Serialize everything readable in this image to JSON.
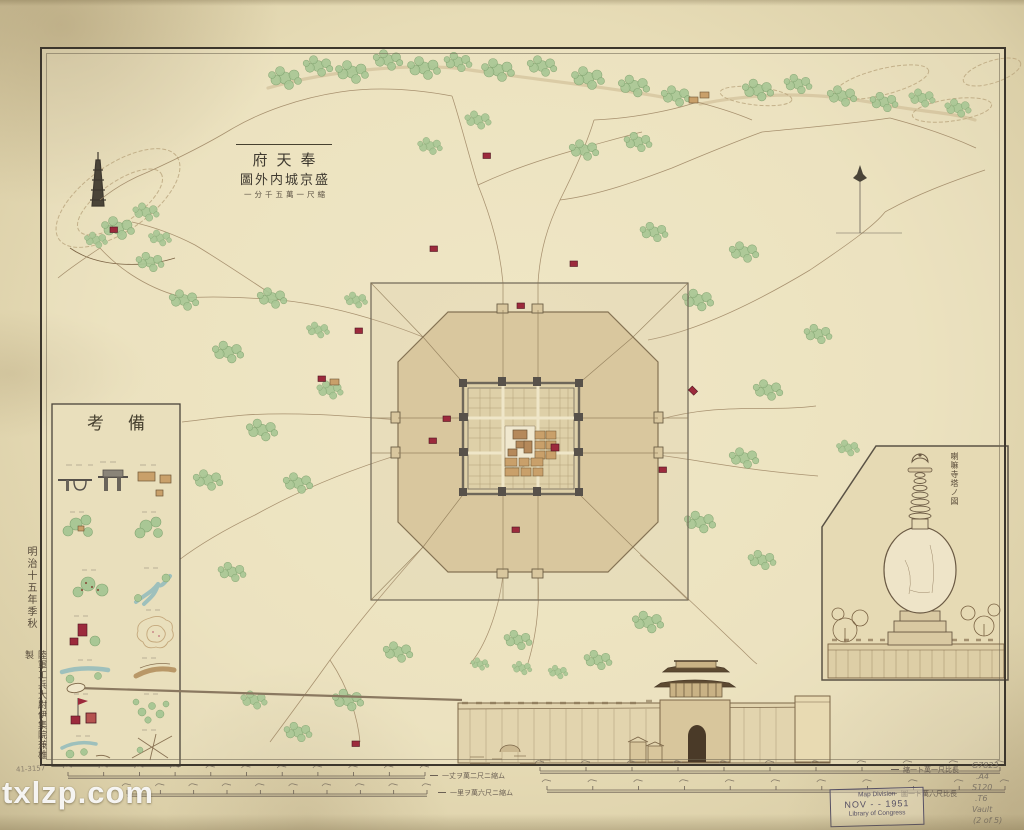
{
  "page": {
    "description": "Aged hand-drawn Japanese survey map of Shengjing (Mukden) inner and outer city, Meiji era, Library of Congress copy"
  },
  "title_block": {
    "line1": "府天奉",
    "line2": "圖外内城京盛",
    "scale_note": "一分千五萬一尺縮"
  },
  "legend": {
    "header": "考備",
    "rows": [
      {
        "left": "city-gate-symbol",
        "right": "official-building-symbol"
      },
      {
        "left": "temple-grove-symbol",
        "right": "village-grove-symbol"
      },
      {
        "left": "hamlet-dots-symbol",
        "right": "river-fork-symbol"
      },
      {
        "left": "shrine-red-square-symbol",
        "right": "hill-contour-symbol"
      },
      {
        "left": "stream-symbol",
        "right": "highway-symbol"
      },
      {
        "left": "flag-and-shrines-symbol",
        "right": "marsh-scatter-symbol"
      },
      {
        "left": "embankment-stream-symbol",
        "right": "road-junction-symbol"
      }
    ]
  },
  "margins": {
    "left_top_note": "明治十五年季秋",
    "left_bottom_note": "陸軍工兵大尉伊集院兼雄製",
    "corner_number": "41-3157"
  },
  "insets": {
    "pagoda_caption": "喇嘛寺塔ノ図"
  },
  "scale_bars": {
    "row1_left_label": "一丈ヲ萬二尺ニ縮ム",
    "row1_right_label": "縮一ト萬一尺比長",
    "row2_left_label": "一里ヲ萬六尺ニ縮ム",
    "row2_right_label": "圖一ト萬六尺比長",
    "bars": [
      {
        "x1": 68,
        "x2": 425,
        "y": 776,
        "ticks": 10
      },
      {
        "x1": 540,
        "x2": 1000,
        "y": 771,
        "ticks": 10
      },
      {
        "x1": 127,
        "x2": 427,
        "y": 794,
        "ticks": 9
      },
      {
        "x1": 547,
        "x2": 1005,
        "y": 790,
        "ticks": 10
      }
    ]
  },
  "stamps": {
    "loc_line1": "Map Division",
    "loc_line2": "NOV - - 1951",
    "loc_line3": "Library of Congress",
    "pencil_notes": [
      "G7823",
      ".A4",
      "S120",
      ".T6",
      "Vault",
      "(2 of 5)"
    ]
  },
  "watermark": "txlzp.com",
  "colors": {
    "paper": "#e7dcb6",
    "ink": "#3f3a30",
    "wall_gray": "#6e675a",
    "outer_city_tan": "#d9c79e",
    "tree_green": "#a9c795",
    "shrine_red": "#9c2a3c",
    "building_tan": "#c9a06a",
    "river_blue": "#9ec0bc",
    "stamp_purple": "#565064"
  },
  "map_features": {
    "trees": [
      [
        285,
        78,
        1
      ],
      [
        318,
        66,
        0.9
      ],
      [
        352,
        72,
        1
      ],
      [
        388,
        60,
        0.9
      ],
      [
        424,
        68,
        1
      ],
      [
        458,
        62,
        0.85
      ],
      [
        498,
        70,
        1
      ],
      [
        542,
        66,
        0.9
      ],
      [
        588,
        78,
        1
      ],
      [
        634,
        86,
        0.95
      ],
      [
        676,
        96,
        0.9
      ],
      [
        584,
        150,
        0.9
      ],
      [
        638,
        142,
        0.85
      ],
      [
        478,
        120,
        0.8
      ],
      [
        430,
        146,
        0.75
      ],
      [
        758,
        90,
        0.95
      ],
      [
        798,
        84,
        0.85
      ],
      [
        842,
        96,
        0.9
      ],
      [
        884,
        102,
        0.85
      ],
      [
        922,
        98,
        0.8
      ],
      [
        958,
        108,
        0.8
      ],
      [
        150,
        262,
        0.85
      ],
      [
        184,
        300,
        0.9
      ],
      [
        228,
        352,
        0.95
      ],
      [
        272,
        298,
        0.9
      ],
      [
        318,
        330,
        0.7
      ],
      [
        356,
        300,
        0.7
      ],
      [
        262,
        430,
        0.95
      ],
      [
        208,
        480,
        0.9
      ],
      [
        158,
        552,
        0.9
      ],
      [
        232,
        572,
        0.85
      ],
      [
        298,
        483,
        0.9
      ],
      [
        330,
        390,
        0.8
      ],
      [
        698,
        300,
        0.95
      ],
      [
        744,
        252,
        0.9
      ],
      [
        654,
        232,
        0.85
      ],
      [
        768,
        390,
        0.9
      ],
      [
        818,
        334,
        0.85
      ],
      [
        744,
        458,
        0.9
      ],
      [
        700,
        522,
        0.95
      ],
      [
        762,
        560,
        0.85
      ],
      [
        848,
        448,
        0.7
      ],
      [
        648,
        622,
        0.95
      ],
      [
        598,
        660,
        0.85
      ],
      [
        518,
        640,
        0.85
      ],
      [
        398,
        652,
        0.9
      ],
      [
        348,
        700,
        0.95
      ],
      [
        298,
        732,
        0.85
      ],
      [
        254,
        700,
        0.8
      ],
      [
        522,
        668,
        0.6
      ],
      [
        558,
        672,
        0.6
      ],
      [
        480,
        664,
        0.55
      ],
      [
        118,
        228,
        1
      ],
      [
        146,
        212,
        0.8
      ],
      [
        96,
        240,
        0.7
      ],
      [
        160,
        238,
        0.7
      ]
    ],
    "villages": [
      [
        693,
        100,
        "t"
      ],
      [
        704,
        95,
        "t"
      ],
      [
        487,
        156,
        "r"
      ],
      [
        574,
        264,
        "r"
      ],
      [
        434,
        249,
        "r"
      ],
      [
        322,
        379,
        "r"
      ],
      [
        334,
        382,
        "t"
      ],
      [
        693,
        391,
        "d"
      ],
      [
        663,
        470,
        "r"
      ],
      [
        516,
        530,
        "r"
      ],
      [
        447,
        419,
        "r"
      ],
      [
        433,
        441,
        "r"
      ],
      [
        359,
        331,
        "r"
      ],
      [
        356,
        744,
        "r"
      ],
      [
        521,
        306,
        "r"
      ],
      [
        114,
        230,
        "r"
      ]
    ]
  }
}
